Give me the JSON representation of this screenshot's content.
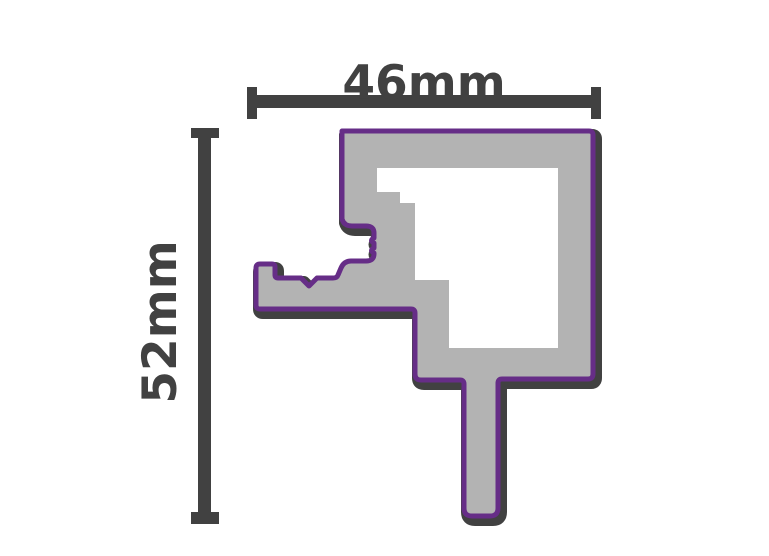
{
  "figure": {
    "title": "profile-cross-section-technical-drawing",
    "width_dimension": "46mm",
    "height_dimension": "52mm"
  },
  "colors": {
    "background": "#ffffff",
    "outline_dark": "#414141",
    "profile_fill_gray": "#b3b3b3",
    "profile_outline_purple": "#662d87",
    "dimension_line": "#414141",
    "dimension_text": "#414141"
  }
}
